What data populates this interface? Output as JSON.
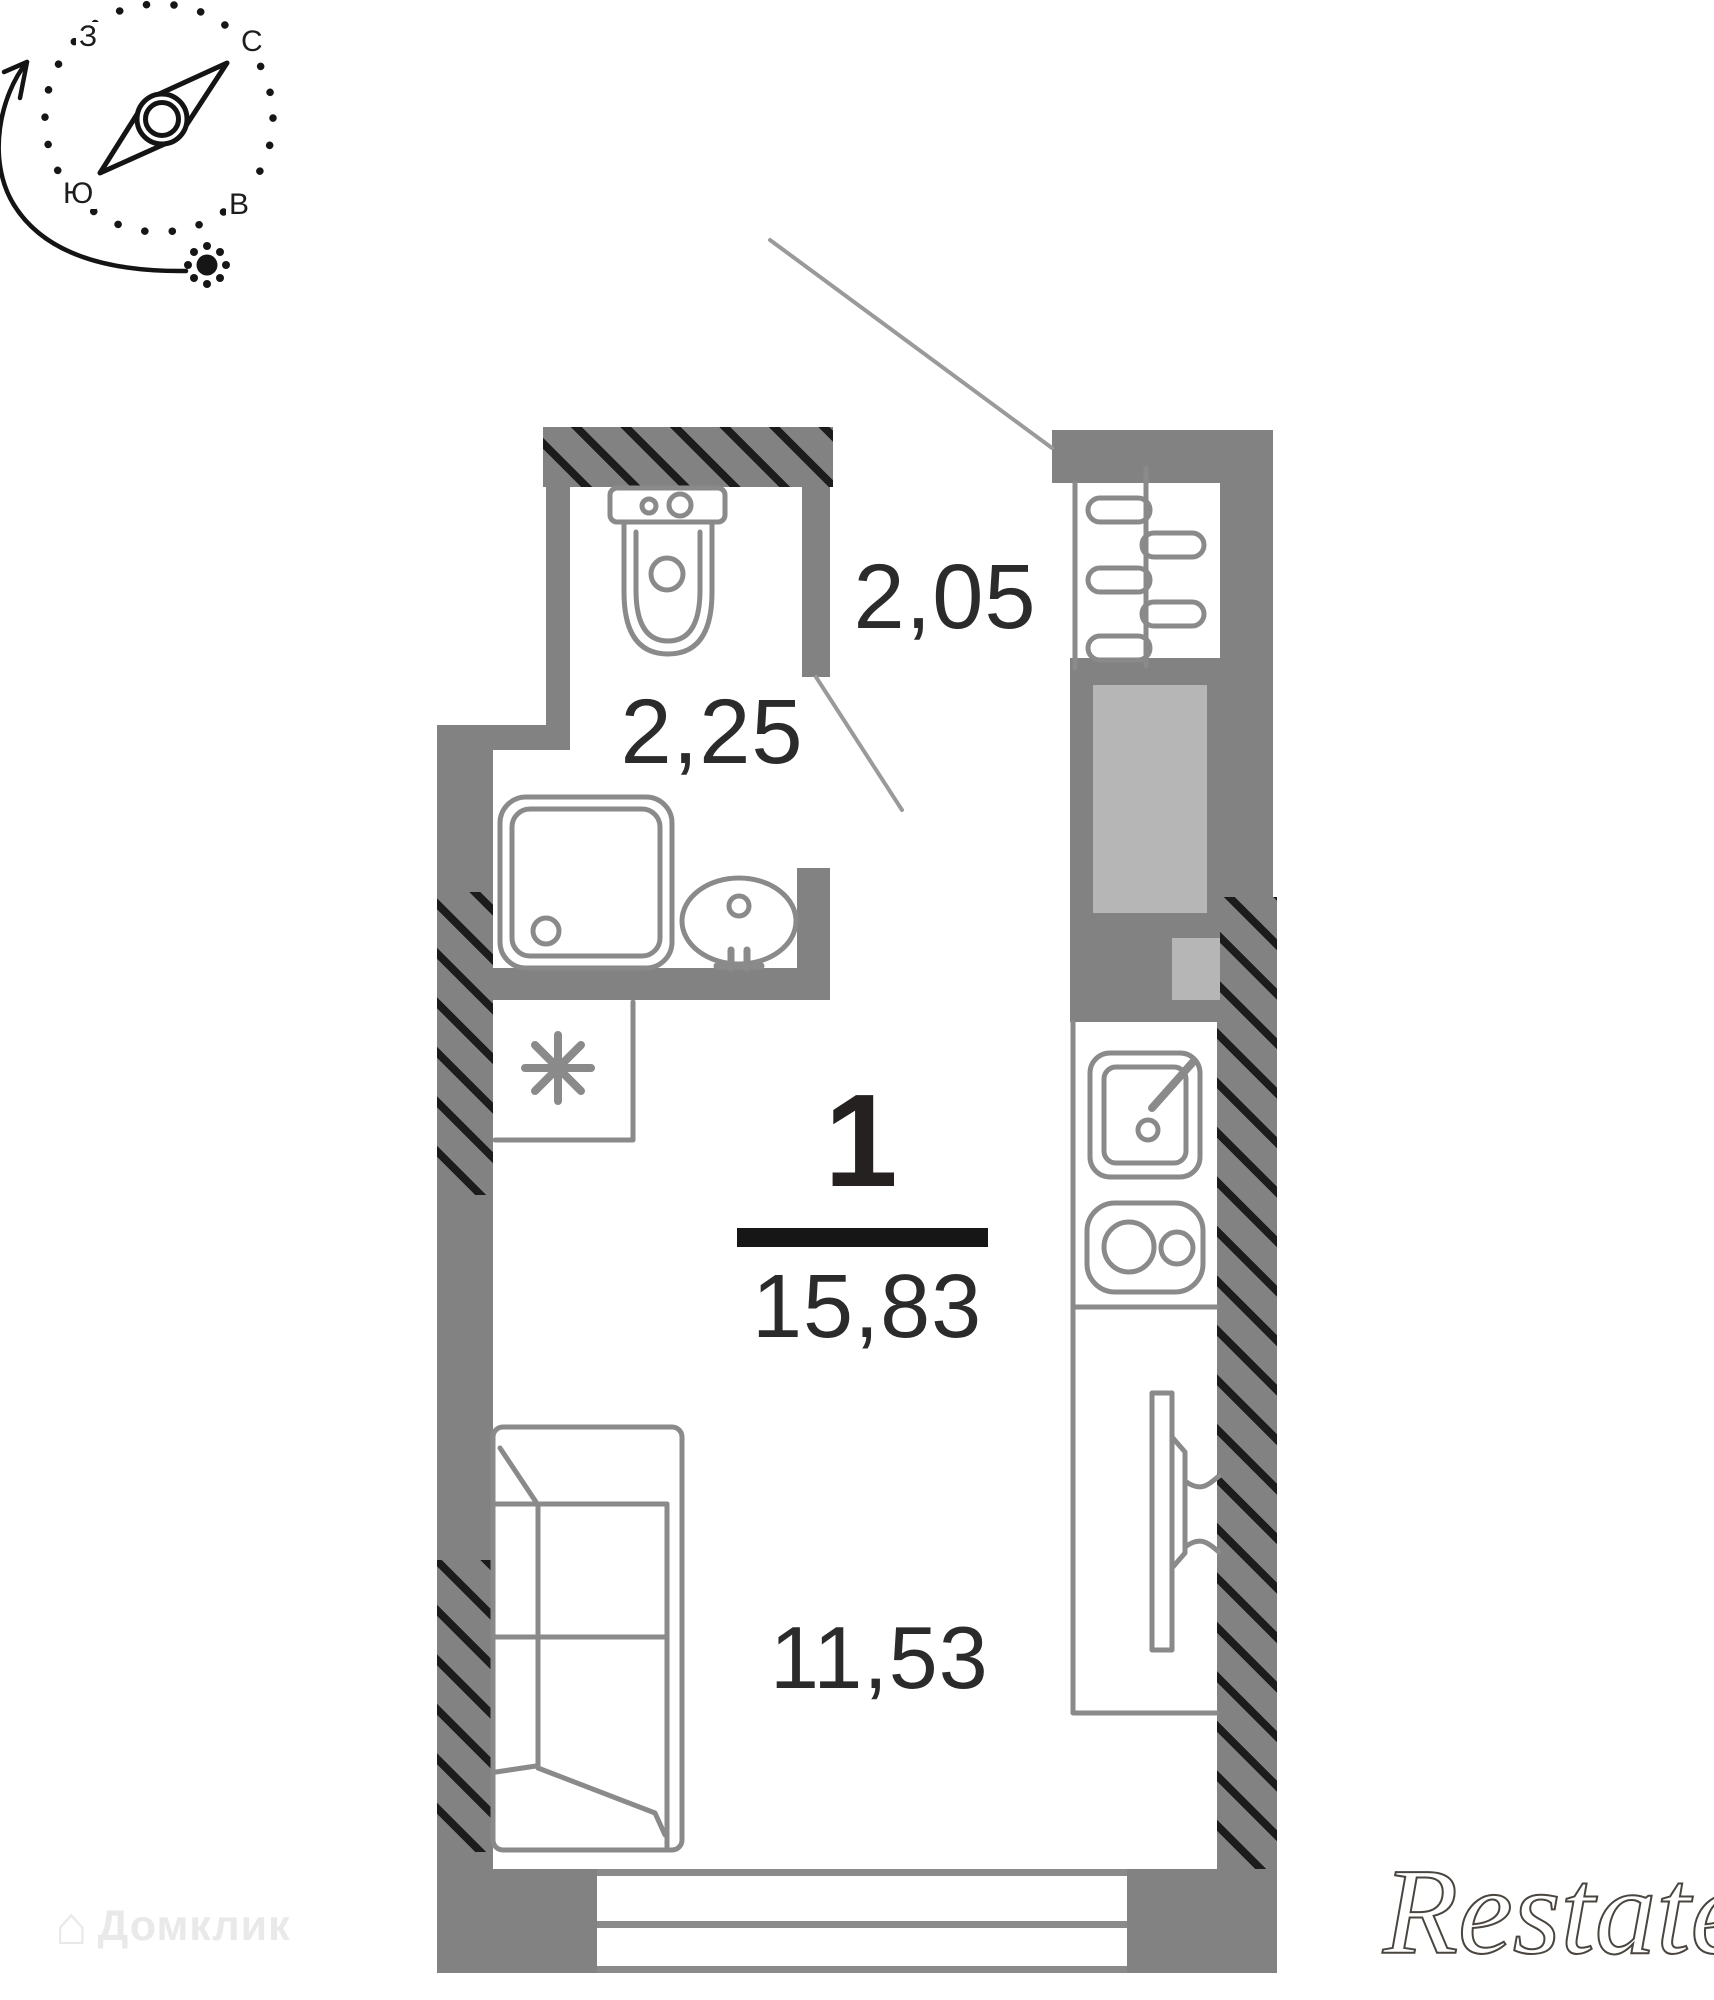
{
  "compass": {
    "labels": {
      "north": "С",
      "east": "В",
      "south": "Ю",
      "west": "З"
    },
    "icons": [
      "compass-needle-icon",
      "sun-icon",
      "sun-path-arrow-icon",
      "dotted-ring-icon"
    ]
  },
  "plan": {
    "summary": {
      "rooms_count": "1",
      "total_area": "15,83"
    },
    "rooms": [
      {
        "name": "hallway",
        "area_label": "2,05"
      },
      {
        "name": "bathroom",
        "area_label": "2,25"
      },
      {
        "name": "living-kitchen",
        "area_label": "11,53"
      }
    ],
    "fixtures": [
      "toilet",
      "shower",
      "bathroom-sink",
      "washing-machine-spot",
      "radiator",
      "ventilation-shaft",
      "kitchen-sink",
      "stove",
      "wall-mounted-tv",
      "sofa",
      "window",
      "entrance-door-leader",
      "bathroom-door-leader"
    ]
  },
  "watermarks": {
    "bottom_left": "Домклик",
    "bottom_right": "Restate"
  },
  "colors": {
    "wall": "#828282",
    "hatch": "#1c1c1c",
    "shaft_fill": "#b6b6b6",
    "fixture_stroke": "#8a8a8a",
    "text": "#2b2b2b",
    "divider": "#161616",
    "leader_line": "#9a9a9a",
    "watermark_light": "#e9e9e9",
    "watermark_dark": "#4a453f"
  }
}
